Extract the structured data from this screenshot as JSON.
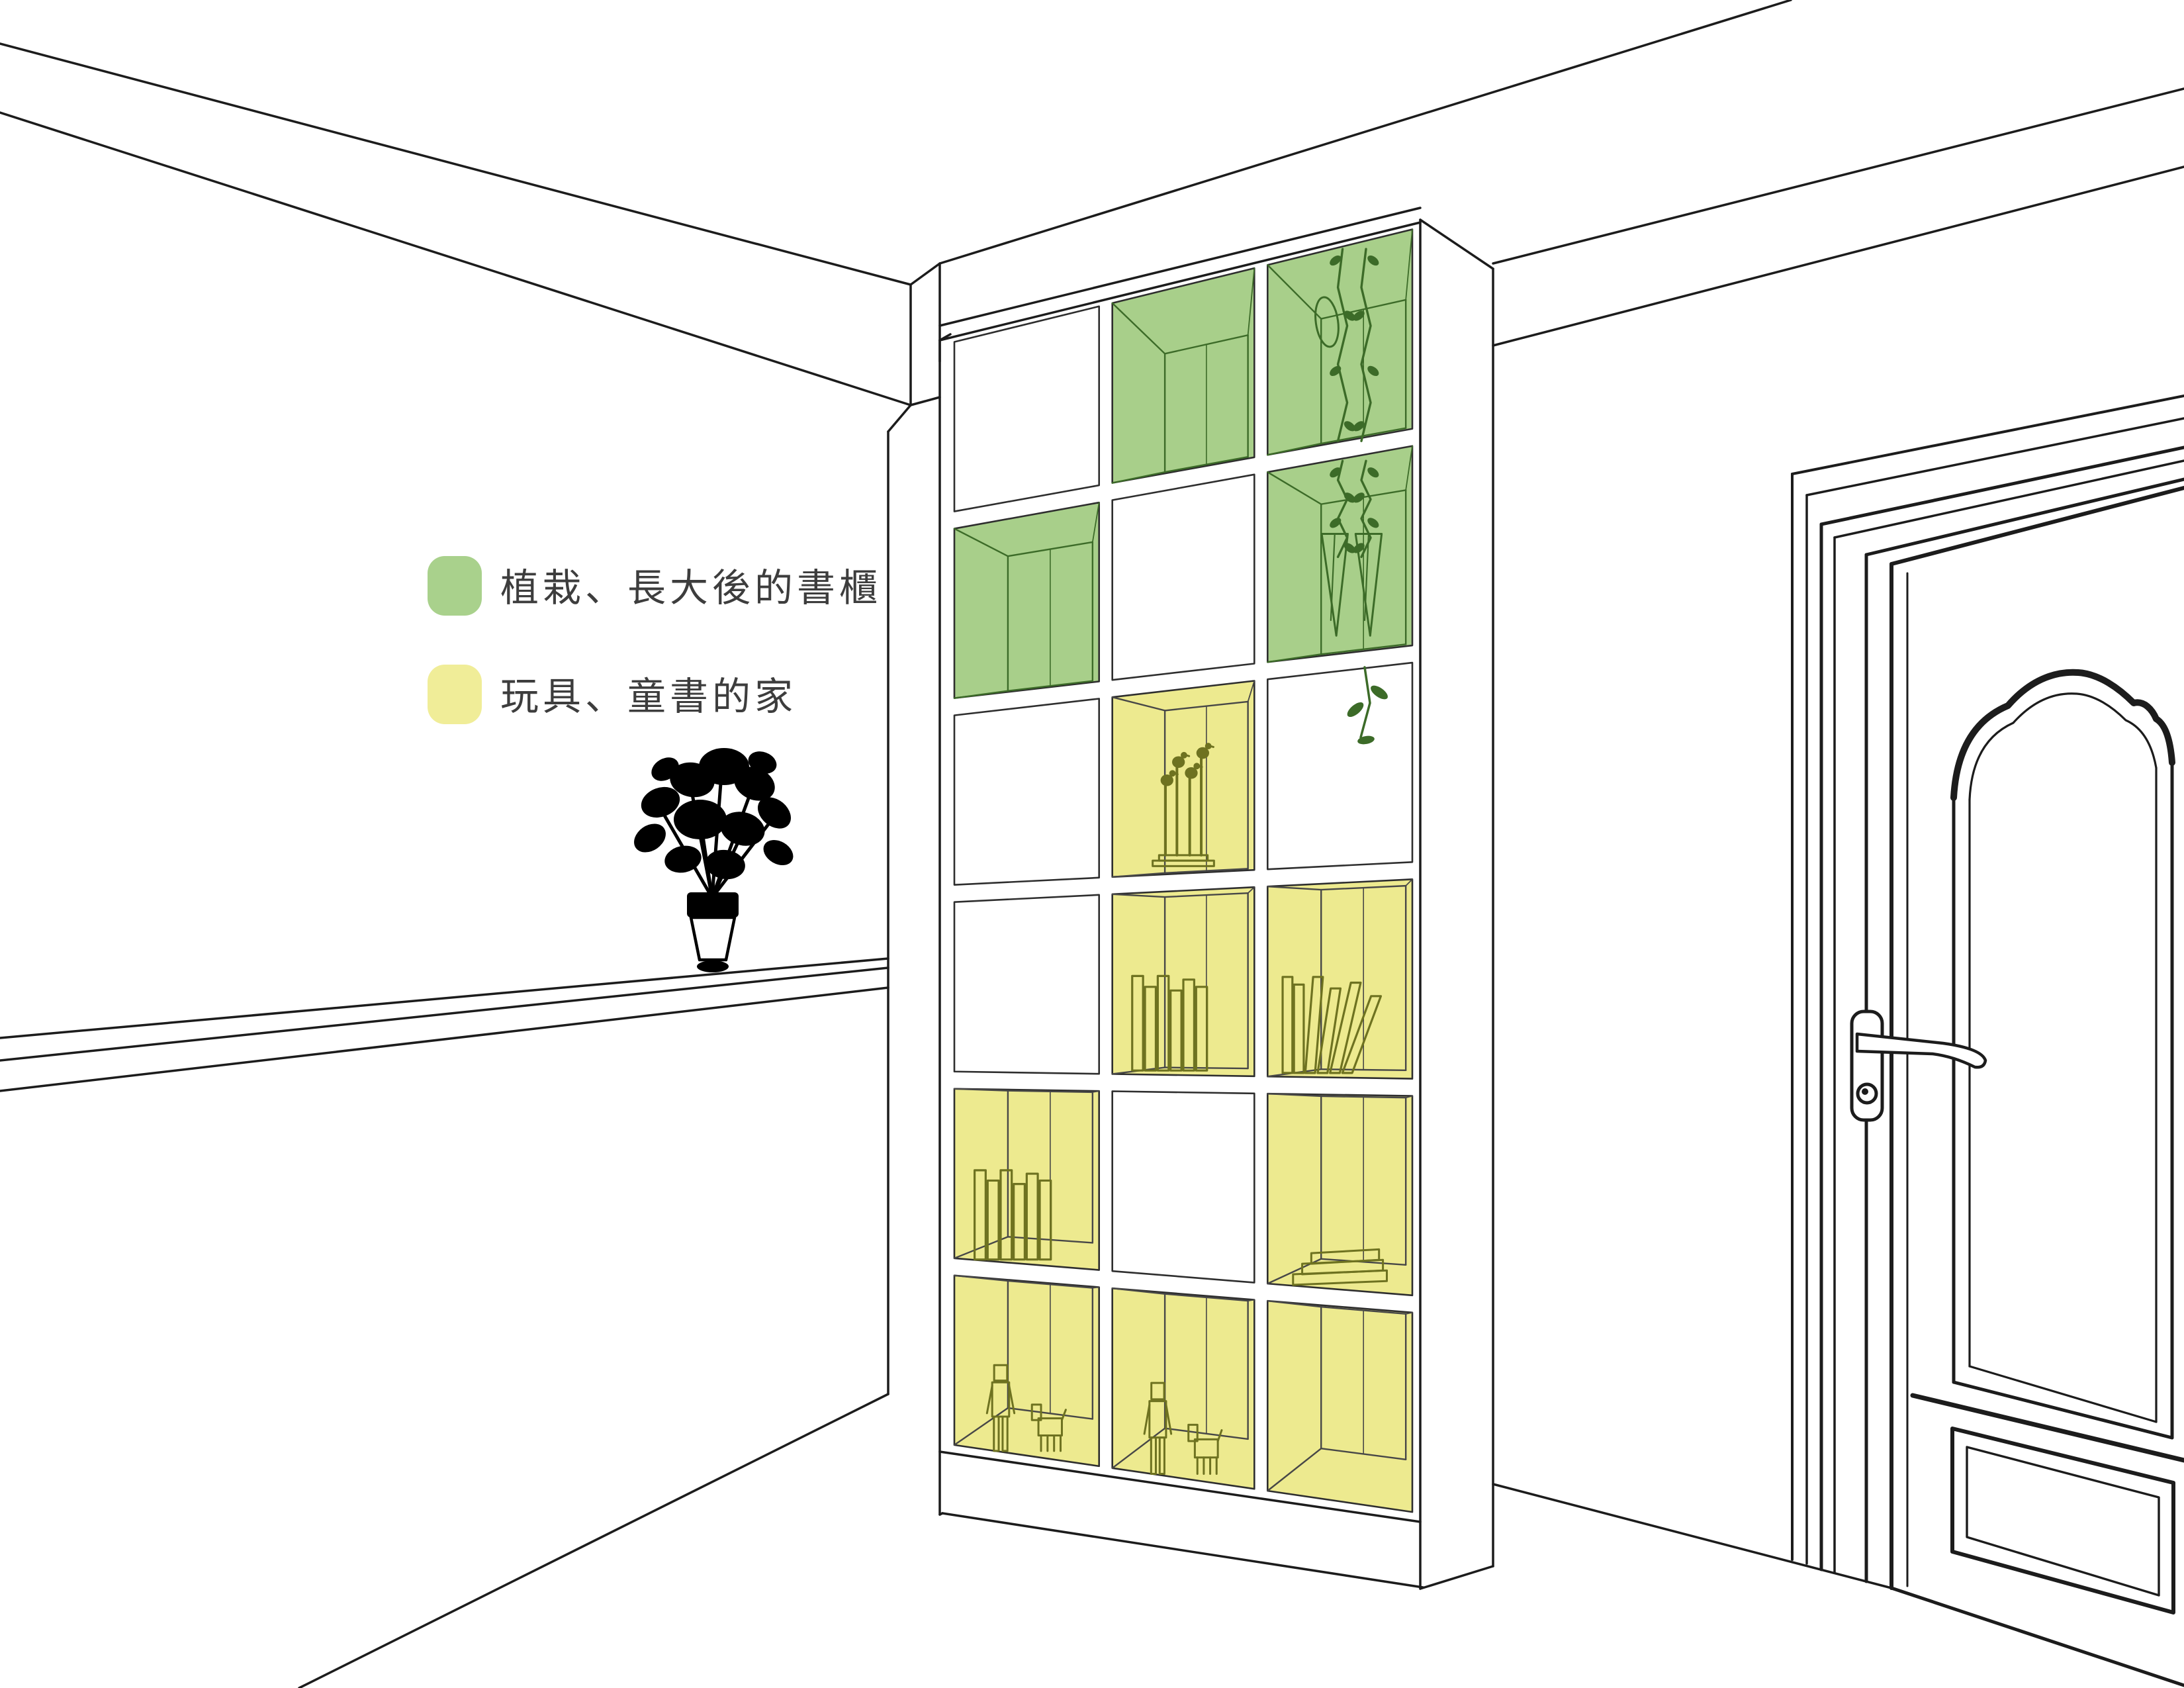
{
  "legend": {
    "items": [
      {
        "label": "植栽、長大後的書櫃",
        "color": "#a9d18c",
        "meaning": "green-cells"
      },
      {
        "label": "玩具、童書的家",
        "color": "#f0ed98",
        "meaning": "yellow-cells"
      }
    ]
  },
  "colors": {
    "background": "#ffffff",
    "line": "#1c1c1c",
    "green_cell": "#a8cf8a",
    "yellow_cell": "#edea8f",
    "toy_line": "#6e7220",
    "plant_line": "#3c6b28",
    "interior_line": "#474747",
    "legend_text": "#3d3d3d"
  },
  "bookshelf": {
    "columns": 3,
    "rows": 6,
    "cells": [
      {
        "col": 0,
        "row": 0,
        "fill": "white",
        "content": "none"
      },
      {
        "col": 1,
        "row": 0,
        "fill": "green",
        "content": "empty"
      },
      {
        "col": 2,
        "row": 0,
        "fill": "green",
        "content": "hanging-plant-upper"
      },
      {
        "col": 0,
        "row": 1,
        "fill": "green",
        "content": "empty"
      },
      {
        "col": 1,
        "row": 1,
        "fill": "white",
        "content": "none"
      },
      {
        "col": 2,
        "row": 1,
        "fill": "green",
        "content": "hanging-plant-lower"
      },
      {
        "col": 0,
        "row": 2,
        "fill": "white",
        "content": "none"
      },
      {
        "col": 1,
        "row": 2,
        "fill": "yellow",
        "content": "bird-sculpture"
      },
      {
        "col": 2,
        "row": 2,
        "fill": "white",
        "content": "none"
      },
      {
        "col": 0,
        "row": 3,
        "fill": "white",
        "content": "none"
      },
      {
        "col": 1,
        "row": 3,
        "fill": "yellow",
        "content": "upright-books"
      },
      {
        "col": 2,
        "row": 3,
        "fill": "yellow",
        "content": "leaning-books"
      },
      {
        "col": 0,
        "row": 4,
        "fill": "yellow",
        "content": "upright-books"
      },
      {
        "col": 1,
        "row": 4,
        "fill": "white",
        "content": "none"
      },
      {
        "col": 2,
        "row": 4,
        "fill": "yellow",
        "content": "stepped-riser"
      },
      {
        "col": 0,
        "row": 5,
        "fill": "yellow",
        "content": "robot-toys"
      },
      {
        "col": 1,
        "row": 5,
        "fill": "yellow",
        "content": "robot-toys"
      },
      {
        "col": 2,
        "row": 5,
        "fill": "yellow",
        "content": "empty"
      }
    ]
  },
  "scene": {
    "objects": [
      "ceiling-beam",
      "room-corner",
      "wall-ledge",
      "flower-vase-silhouette",
      "cube-bookshelf",
      "paneled-door",
      "door-lever-handle",
      "door-keyhole"
    ]
  }
}
